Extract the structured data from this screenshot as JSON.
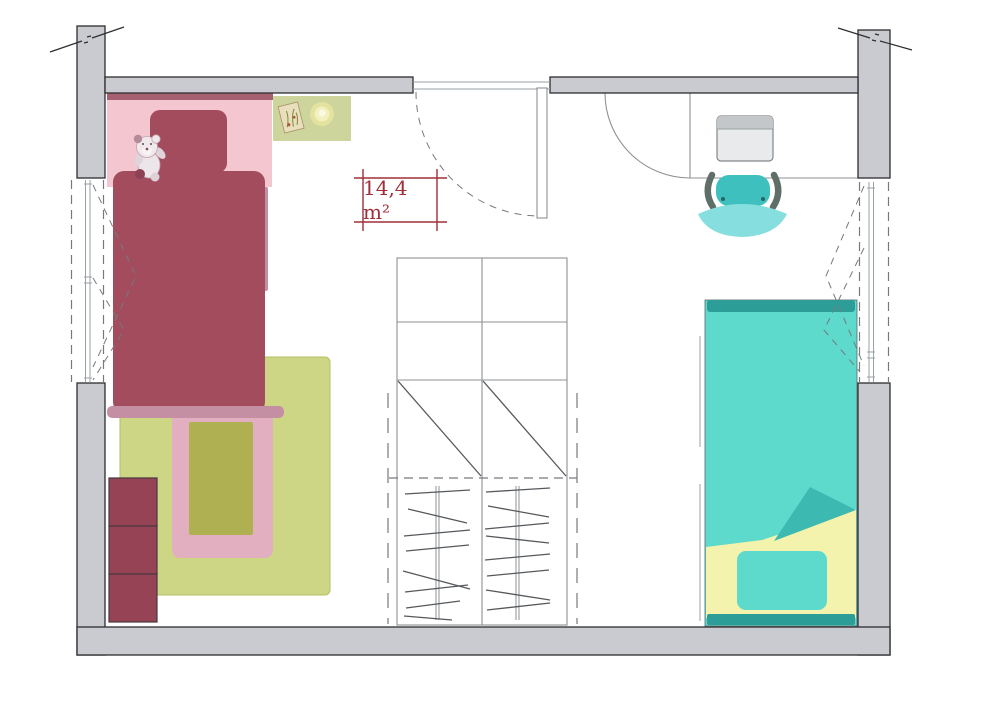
{
  "area_label": {
    "text": "14,4 m²"
  },
  "palette": {
    "wall": "#c9cbd1",
    "wall-line": "#2e2e31",
    "line-mid": "#8e9094",
    "line-thin": "#9aa0a4",
    "dash": "#77797d",
    "hanger": "#55585c",
    "pink": "#f4c6cf",
    "mauve": "#c58fa3",
    "mauve-dark": "#a5616f",
    "red": "#a24c5e",
    "drawer": "#964355",
    "drawer-line": "#47383c",
    "rug-green": "#cdd685",
    "rug-edge": "#b6bf67",
    "rug-pink": "#e2afc1",
    "rug-olive": "#aeb051",
    "stand": "#cdd59d",
    "teal": "#5edacc",
    "teal-edge": "#57666a",
    "teal-dark": "#2d9e97",
    "teal-mid": "#3cbab2",
    "bed-yellow": "#f4f3ad",
    "chair": "#3ec1be",
    "chair-light": "#86dfde",
    "chair-arm": "#5f6f68",
    "monitor-frame": "#c3c7c9",
    "monitor-screen": "#e8eaeb",
    "monitor-line": "#83878a",
    "label-red": "#a02e38"
  },
  "items": {
    "room": "child bedroom 14,4 m2",
    "furniture": [
      "pink bed with teddy bear",
      "nightstand with lamp",
      "rug",
      "drawer stack",
      "wardrobe with hanging rails",
      "teal bed",
      "desk with monitor",
      "desk chair"
    ],
    "openings": [
      "door top center",
      "window left wall",
      "window right wall"
    ]
  }
}
